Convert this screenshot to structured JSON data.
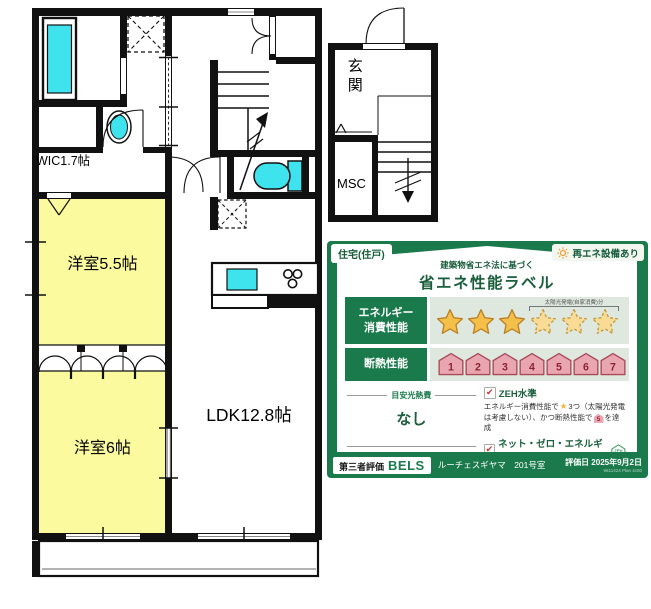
{
  "floorplan": {
    "wic_label": "WIC1.7帖",
    "bedroom1_label": "洋室5.5帖",
    "bedroom2_label": "洋室6帖",
    "ldk_label": "LDK12.8帖",
    "entrance_label": "玄関",
    "msc_label": "MSC"
  },
  "energy_label": {
    "type_badge": "住宅(住戸)",
    "renewable_badge": "再エネ設備あり",
    "subtitle": "建築物省エネ法に基づく",
    "title": "省エネ性能ラベル",
    "icons": {
      "star": "★",
      "check": "✔"
    },
    "colors": {
      "panel_green": "#1A7A4C",
      "text_green": "#1A5E3C",
      "band": "#DEE8DE",
      "star_gold": "#F4C04A",
      "star_gold_dashed": "#F8DC96",
      "house_pink": "#EAA6B0",
      "house_number": "#8D2434",
      "fixture_cyan": "#3FE3EE",
      "room_yellow": "#FBFA9E"
    },
    "energy_row": {
      "label_line1": "エネルギー",
      "label_line2": "消費性能",
      "stars_solid": 3,
      "stars_dashed": 3,
      "solar_note": "太陽光発電(自家消費)分"
    },
    "insulation_row": {
      "label": "断熱性能",
      "levels": [
        "1",
        "2",
        "3",
        "4",
        "5",
        "6",
        "7"
      ]
    },
    "cost": {
      "title": "目安光熱費",
      "value": "なし"
    },
    "zeh": {
      "heading": "ZEH水準",
      "desc_part1": "エネルギー消費性能で",
      "desc_part2": "3つ（太陽光発電は考慮しない）、かつ断熱性能で",
      "badge_level": "5",
      "desc_part3": "を達成"
    },
    "nze": {
      "heading": "ネット・ゼロ・エネルギー",
      "logo_text": "ZEH",
      "desc": "太陽光発電の売電分も含めてエネルギー収支がゼロ以下を達成"
    },
    "footer": {
      "cert_label": "第三者評価",
      "cert_brand": "BELS",
      "property_name": "ルーチェスギヤマ　201号室",
      "eval_date": "評価日 2025年9月2日",
      "code": "9611424 Plan 4c00"
    }
  }
}
